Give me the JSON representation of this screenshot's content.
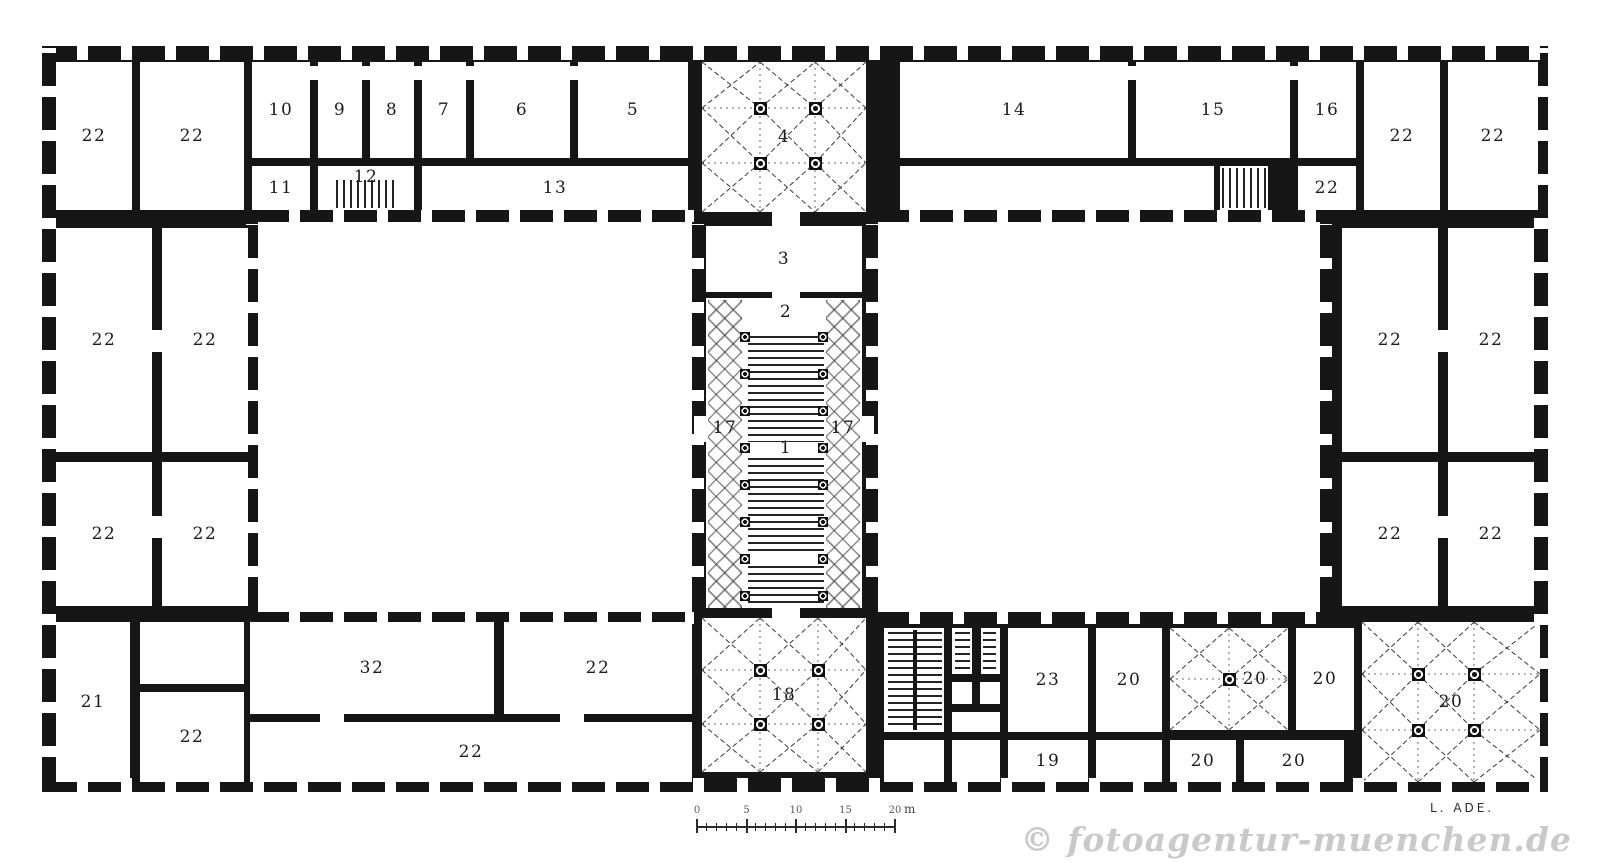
{
  "watermark": "© fotoagentur-muenchen.de",
  "signature": "L. ADE.",
  "colors": {
    "ink": "#161616",
    "paper": "#ffffff",
    "watermark": "#c9c9c9"
  },
  "scalebar": {
    "labels": [
      "0",
      "5",
      "10",
      "15",
      "20"
    ],
    "unit": "m"
  },
  "plan": {
    "building": {
      "x": 42,
      "y": 46,
      "w": 1506,
      "h": 746
    },
    "courtyards": [
      {
        "x": 258,
        "y": 222,
        "w": 434,
        "h": 390
      },
      {
        "x": 878,
        "y": 222,
        "w": 442,
        "h": 390
      }
    ],
    "rooms": [
      {
        "label": "22",
        "x": 56,
        "y": 62,
        "w": 76,
        "h": 148
      },
      {
        "label": "22",
        "x": 140,
        "y": 62,
        "w": 104,
        "h": 148
      },
      {
        "label": "10",
        "x": 252,
        "y": 62,
        "w": 58,
        "h": 96
      },
      {
        "label": "9",
        "x": 318,
        "y": 62,
        "w": 44,
        "h": 96
      },
      {
        "label": "8",
        "x": 370,
        "y": 62,
        "w": 44,
        "h": 96
      },
      {
        "label": "7",
        "x": 422,
        "y": 62,
        "w": 44,
        "h": 96
      },
      {
        "label": "6",
        "x": 474,
        "y": 62,
        "w": 96,
        "h": 96
      },
      {
        "label": "5",
        "x": 578,
        "y": 62,
        "w": 110,
        "h": 96
      },
      {
        "label": "11",
        "x": 252,
        "y": 166,
        "w": 58,
        "h": 44
      },
      {
        "label": "12",
        "x": 318,
        "y": 166,
        "w": 96,
        "h": 44,
        "ldy": -11
      },
      {
        "label": "13",
        "x": 422,
        "y": 166,
        "w": 266,
        "h": 44
      },
      {
        "label": "4",
        "x": 702,
        "y": 62,
        "w": 164,
        "h": 150,
        "vault": [
          [
            58,
            46
          ],
          [
            113,
            46
          ],
          [
            58,
            101
          ],
          [
            113,
            101
          ]
        ]
      },
      {
        "label": "14",
        "x": 900,
        "y": 62,
        "w": 228,
        "h": 96
      },
      {
        "label": "15",
        "x": 1136,
        "y": 62,
        "w": 154,
        "h": 96
      },
      {
        "label": "16",
        "x": 1298,
        "y": 62,
        "w": 58,
        "h": 96
      },
      {
        "label": "",
        "x": 900,
        "y": 166,
        "w": 314,
        "h": 44
      },
      {
        "label": "",
        "x": 1220,
        "y": 166,
        "w": 48,
        "h": 44
      },
      {
        "label": "22",
        "x": 1298,
        "y": 166,
        "w": 58,
        "h": 44
      },
      {
        "label": "22",
        "x": 1364,
        "y": 62,
        "w": 76,
        "h": 148
      },
      {
        "label": "22",
        "x": 1448,
        "y": 62,
        "w": 90,
        "h": 148
      },
      {
        "label": "22",
        "x": 56,
        "y": 228,
        "w": 96,
        "h": 224
      },
      {
        "label": "22",
        "x": 162,
        "y": 228,
        "w": 86,
        "h": 224
      },
      {
        "label": "22",
        "x": 56,
        "y": 462,
        "w": 96,
        "h": 144
      },
      {
        "label": "22",
        "x": 162,
        "y": 462,
        "w": 86,
        "h": 144
      },
      {
        "label": "22",
        "x": 1342,
        "y": 228,
        "w": 96,
        "h": 224
      },
      {
        "label": "22",
        "x": 1448,
        "y": 228,
        "w": 86,
        "h": 224
      },
      {
        "label": "22",
        "x": 1342,
        "y": 462,
        "w": 96,
        "h": 144
      },
      {
        "label": "22",
        "x": 1448,
        "y": 462,
        "w": 86,
        "h": 144
      },
      {
        "label": "3",
        "x": 706,
        "y": 226,
        "w": 156,
        "h": 66
      },
      {
        "label": "",
        "x": 706,
        "y": 298,
        "w": 156,
        "h": 310
      },
      {
        "label": "18",
        "x": 702,
        "y": 618,
        "w": 164,
        "h": 154,
        "vault": [
          [
            58,
            52
          ],
          [
            116,
            52
          ],
          [
            58,
            106
          ],
          [
            116,
            106
          ]
        ]
      },
      {
        "label": "21",
        "x": 56,
        "y": 622,
        "w": 74,
        "h": 160
      },
      {
        "label": "",
        "x": 140,
        "y": 622,
        "w": 104,
        "h": 62
      },
      {
        "label": "22",
        "x": 140,
        "y": 692,
        "w": 104,
        "h": 90
      },
      {
        "label": "32",
        "x": 250,
        "y": 622,
        "w": 244,
        "h": 92
      },
      {
        "label": "22",
        "x": 504,
        "y": 622,
        "w": 188,
        "h": 92
      },
      {
        "label": "22",
        "x": 250,
        "y": 722,
        "w": 442,
        "h": 60
      },
      {
        "label": "",
        "x": 884,
        "y": 628,
        "w": 60,
        "h": 104
      },
      {
        "label": "",
        "x": 884,
        "y": 740,
        "w": 60,
        "h": 42
      },
      {
        "label": "",
        "x": 952,
        "y": 628,
        "w": 48,
        "h": 46
      },
      {
        "label": "",
        "x": 952,
        "y": 682,
        "w": 20,
        "h": 22
      },
      {
        "label": "",
        "x": 980,
        "y": 682,
        "w": 20,
        "h": 22
      },
      {
        "label": "",
        "x": 952,
        "y": 712,
        "w": 48,
        "h": 20
      },
      {
        "label": "",
        "x": 952,
        "y": 740,
        "w": 48,
        "h": 42
      },
      {
        "label": "23",
        "x": 1008,
        "y": 628,
        "w": 80,
        "h": 104
      },
      {
        "label": "19",
        "x": 1008,
        "y": 740,
        "w": 80,
        "h": 42
      },
      {
        "label": "20",
        "x": 1096,
        "y": 628,
        "w": 66,
        "h": 104
      },
      {
        "label": "",
        "x": 1096,
        "y": 740,
        "w": 66,
        "h": 42
      },
      {
        "label": "20",
        "x": 1170,
        "y": 628,
        "w": 118,
        "h": 102,
        "vault": [
          [
            59,
            51
          ]
        ],
        "ldx": 26
      },
      {
        "label": "20",
        "x": 1170,
        "y": 740,
        "w": 66,
        "h": 42
      },
      {
        "label": "20",
        "x": 1244,
        "y": 740,
        "w": 100,
        "h": 42
      },
      {
        "label": "20",
        "x": 1296,
        "y": 628,
        "w": 58,
        "h": 102
      },
      {
        "label": "20",
        "x": 1362,
        "y": 622,
        "w": 178,
        "h": 160,
        "vault": [
          [
            56,
            52
          ],
          [
            112,
            52
          ],
          [
            56,
            108
          ],
          [
            112,
            108
          ]
        ]
      }
    ],
    "stairs": [
      {
        "x": 336,
        "y": 180,
        "w": 60,
        "h": 28,
        "dir": "v"
      },
      {
        "x": 1222,
        "y": 168,
        "w": 44,
        "h": 40,
        "dir": "v"
      },
      {
        "x": 748,
        "y": 336,
        "w": 76,
        "h": 106,
        "dir": "h"
      },
      {
        "x": 748,
        "y": 458,
        "w": 76,
        "h": 98,
        "dir": "h"
      },
      {
        "x": 748,
        "y": 566,
        "w": 76,
        "h": 42,
        "dir": "h"
      },
      {
        "x": 888,
        "y": 632,
        "w": 25,
        "h": 96,
        "dir": "h"
      },
      {
        "x": 917,
        "y": 632,
        "w": 25,
        "h": 96,
        "dir": "h"
      },
      {
        "x": 955,
        "y": 632,
        "w": 15,
        "h": 38,
        "dir": "h"
      },
      {
        "x": 983,
        "y": 632,
        "w": 13,
        "h": 38,
        "dir": "h"
      }
    ],
    "wall_bits": [
      {
        "x": 913,
        "y": 630,
        "w": 4,
        "h": 100
      },
      {
        "x": 972,
        "y": 628,
        "w": 9,
        "h": 46
      }
    ],
    "aisles": [
      {
        "x": 708,
        "y": 300,
        "w": 34,
        "h": 308
      },
      {
        "x": 826,
        "y": 300,
        "w": 34,
        "h": 308
      }
    ],
    "stair_columns": {
      "xs": [
        745,
        823
      ],
      "ys": [
        337,
        374,
        411,
        448,
        485,
        522,
        559,
        596
      ]
    },
    "free_labels": [
      {
        "t": "2",
        "x": 786,
        "y": 312
      },
      {
        "t": "1",
        "x": 786,
        "y": 448
      },
      {
        "t": "17",
        "x": 725,
        "y": 428
      },
      {
        "t": "17",
        "x": 843,
        "y": 428
      }
    ],
    "doors": [
      {
        "x": 772,
        "y": 212,
        "w": 28,
        "h": 14
      },
      {
        "x": 772,
        "y": 290,
        "w": 28,
        "h": 8
      },
      {
        "x": 772,
        "y": 608,
        "w": 28,
        "h": 10
      },
      {
        "x": 694,
        "y": 416,
        "w": 12,
        "h": 26
      },
      {
        "x": 862,
        "y": 416,
        "w": 12,
        "h": 26
      },
      {
        "x": 152,
        "y": 330,
        "w": 10,
        "h": 22
      },
      {
        "x": 152,
        "y": 516,
        "w": 10,
        "h": 22
      },
      {
        "x": 1438,
        "y": 330,
        "w": 10,
        "h": 22
      },
      {
        "x": 1438,
        "y": 516,
        "w": 10,
        "h": 22
      },
      {
        "x": 310,
        "y": 66,
        "w": 8,
        "h": 14
      },
      {
        "x": 362,
        "y": 66,
        "w": 8,
        "h": 14
      },
      {
        "x": 414,
        "y": 66,
        "w": 8,
        "h": 14
      },
      {
        "x": 466,
        "y": 66,
        "w": 8,
        "h": 14
      },
      {
        "x": 570,
        "y": 66,
        "w": 8,
        "h": 14
      },
      {
        "x": 1128,
        "y": 66,
        "w": 8,
        "h": 14
      },
      {
        "x": 1290,
        "y": 66,
        "w": 8,
        "h": 14
      },
      {
        "x": 320,
        "y": 714,
        "w": 24,
        "h": 8
      },
      {
        "x": 560,
        "y": 714,
        "w": 24,
        "h": 8
      }
    ],
    "window_bands": [
      {
        "x": 44,
        "y": 46,
        "w": 1502,
        "h": 14,
        "dir": "h"
      },
      {
        "x": 44,
        "y": 778,
        "w": 1502,
        "h": 14,
        "dir": "h"
      },
      {
        "x": 42,
        "y": 48,
        "w": 14,
        "h": 742,
        "dir": "v"
      },
      {
        "x": 1534,
        "y": 48,
        "w": 14,
        "h": 742,
        "dir": "v"
      },
      {
        "x": 256,
        "y": 210,
        "w": 438,
        "h": 12,
        "dir": "h"
      },
      {
        "x": 256,
        "y": 612,
        "w": 438,
        "h": 12,
        "dir": "h"
      },
      {
        "x": 246,
        "y": 224,
        "w": 12,
        "h": 386,
        "dir": "v"
      },
      {
        "x": 692,
        "y": 224,
        "w": 12,
        "h": 386,
        "dir": "v"
      },
      {
        "x": 876,
        "y": 210,
        "w": 446,
        "h": 12,
        "dir": "h"
      },
      {
        "x": 876,
        "y": 612,
        "w": 446,
        "h": 12,
        "dir": "h"
      },
      {
        "x": 866,
        "y": 224,
        "w": 12,
        "h": 386,
        "dir": "v"
      },
      {
        "x": 1320,
        "y": 224,
        "w": 12,
        "h": 386,
        "dir": "v"
      }
    ]
  }
}
